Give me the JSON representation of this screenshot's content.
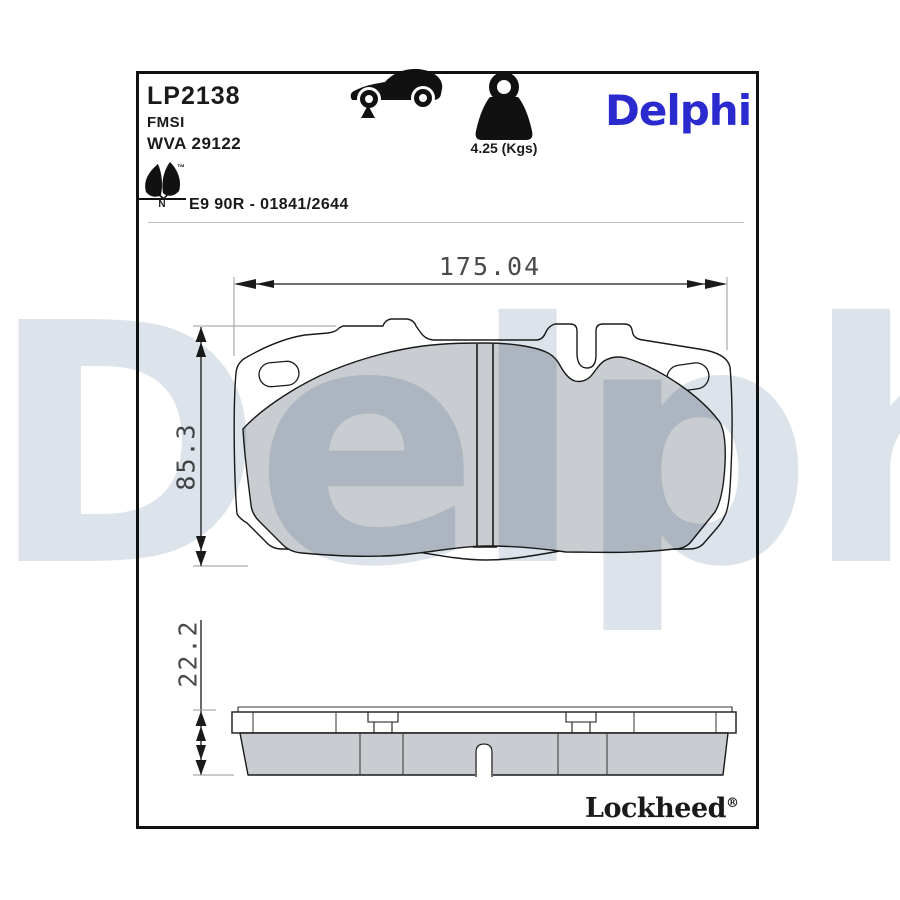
{
  "document": {
    "part_number": "LP2138",
    "fmsi_label": "FMSI",
    "wva_number": "WVA 29122",
    "approval_code": "E9 90R - 01841/2644",
    "weight_label": "4.25 (Kgs)",
    "brand_logo": "Delphi",
    "sub_brand_logo": "Lockheed",
    "registered_mark": "®",
    "trademark_mark": "™",
    "leaf_letter": "N",
    "watermark_text": "Delphi"
  },
  "dimensions": {
    "width_mm": "175.04",
    "height_mm": "85.3",
    "thickness_mm": "22.2"
  },
  "icons": {
    "car": "car-front-axle-icon",
    "weight": "weight-icon",
    "leaf": "eco-leaf-icon"
  },
  "colors": {
    "brand_blue": "#2A2ACF",
    "friction_gray": "#C9CDD2",
    "watermark_gray": "#DCE3EA",
    "line_dark": "#1A1A1A",
    "extension_gray": "#999999"
  }
}
